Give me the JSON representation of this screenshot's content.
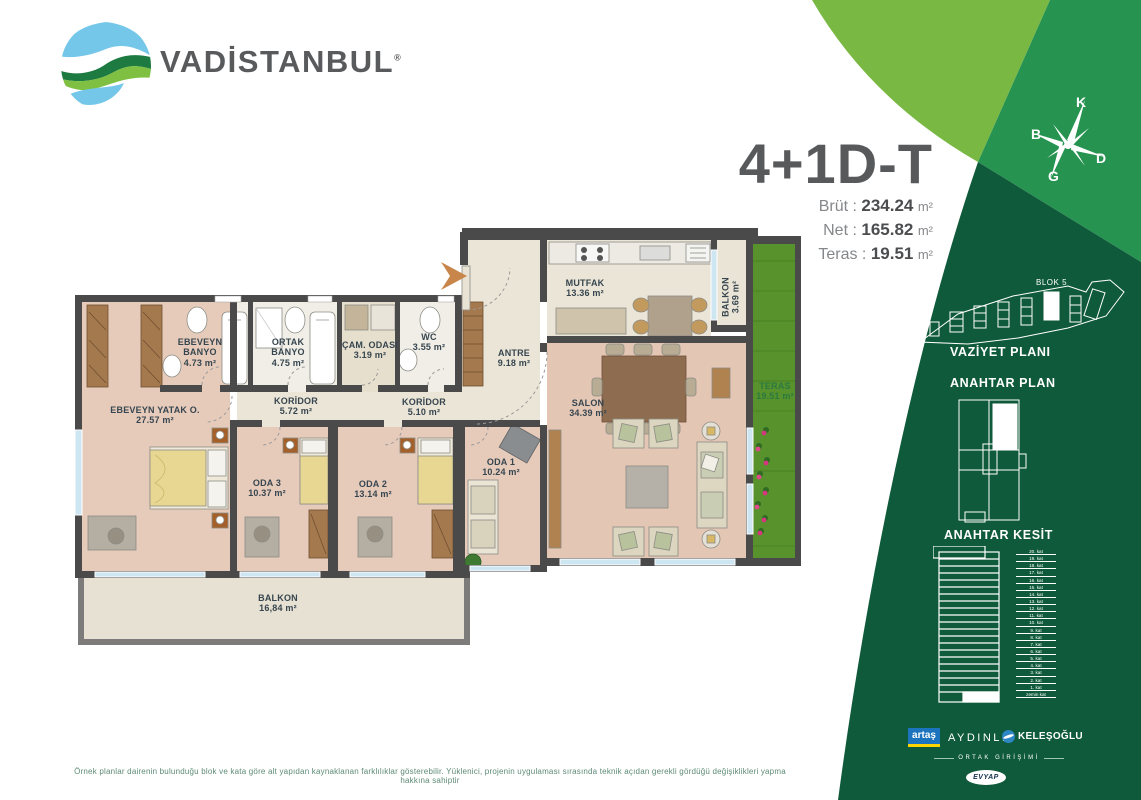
{
  "brand": {
    "name": "VADİSTANBUL",
    "registered": "®"
  },
  "unit": {
    "type": "4+1D-T",
    "metrics": [
      {
        "label": "Brüt :",
        "value": "234.24",
        "unit": "m²"
      },
      {
        "label": "Net :",
        "value": "165.82",
        "unit": "m²"
      },
      {
        "label": "Teras :",
        "value": "19.51",
        "unit": "m²"
      }
    ]
  },
  "compass": {
    "north": "K",
    "west": "B",
    "east": "D",
    "south": "G"
  },
  "plan": {
    "rooms": [
      {
        "name": "EBEVEYN BANYO",
        "area": "4.73 m²"
      },
      {
        "name": "ORTAK BANYO",
        "area": "4.75 m²"
      },
      {
        "name": "ÇAM. ODASI",
        "area": "3.19 m²"
      },
      {
        "name": "WC",
        "area": "3.55 m²"
      },
      {
        "name": "EBEVEYN YATAK O.",
        "area": "27.57 m²"
      },
      {
        "name": "KORİDOR",
        "area": "5.72 m²"
      },
      {
        "name": "KORİDOR",
        "area": "5.10 m²"
      },
      {
        "name": "ANTRE",
        "area": "9.18 m²"
      },
      {
        "name": "MUTFAK",
        "area": "13.36 m²"
      },
      {
        "name": "BALKON",
        "area": "3.69 m²"
      },
      {
        "name": "SALON",
        "area": "34.39 m²"
      },
      {
        "name": "TERAS",
        "area": "19.51 m²"
      },
      {
        "name": "ODA 3",
        "area": "10.37 m²"
      },
      {
        "name": "ODA 2",
        "area": "13.14 m²"
      },
      {
        "name": "ODA 1",
        "area": "10.24 m²"
      },
      {
        "name": "BALKON",
        "area": "16,84 m²"
      }
    ]
  },
  "sidebar": {
    "blok_label": "BLOK 5",
    "vaziyet_title": "VAZİYET PLANI",
    "anahtar_plan_title": "ANAHTAR PLAN",
    "anahtar_kesit_title": "ANAHTAR KESİT",
    "floors": [
      "20. kat",
      "19. kat",
      "18. kat",
      "17. kat",
      "16. kat",
      "15. kat",
      "14. kat",
      "13. kat",
      "12. kat",
      "11. kat",
      "10. kat",
      "9. kat",
      "8. kat",
      "7. kat",
      "6. kat",
      "5. kat",
      "4. kat",
      "3. kat",
      "2. kat",
      "1. kat",
      "zemin kat"
    ],
    "partners": {
      "artas": "artaş",
      "aydinli": "AYDINLI",
      "kelesoglu": "KELEŞOĞLU",
      "joint_label": "ORTAK GİRİŞİMİ",
      "evyap": "EVYAP"
    }
  },
  "footer": {
    "disclaimer": "Örnek planlar dairenin bulunduğu blok ve kata göre alt yapıdan kaynaklanan farklılıklar gösterebilir. Yüklenici, projenin uygulaması sırasında teknik açıdan gerekli gördüğü değişiklikleri yapma hakkına sahiptir"
  },
  "colors": {
    "light_green": "#79b943",
    "mid_green": "#279350",
    "dark_green": "#0f5a3a",
    "title_gray": "#58595b"
  }
}
